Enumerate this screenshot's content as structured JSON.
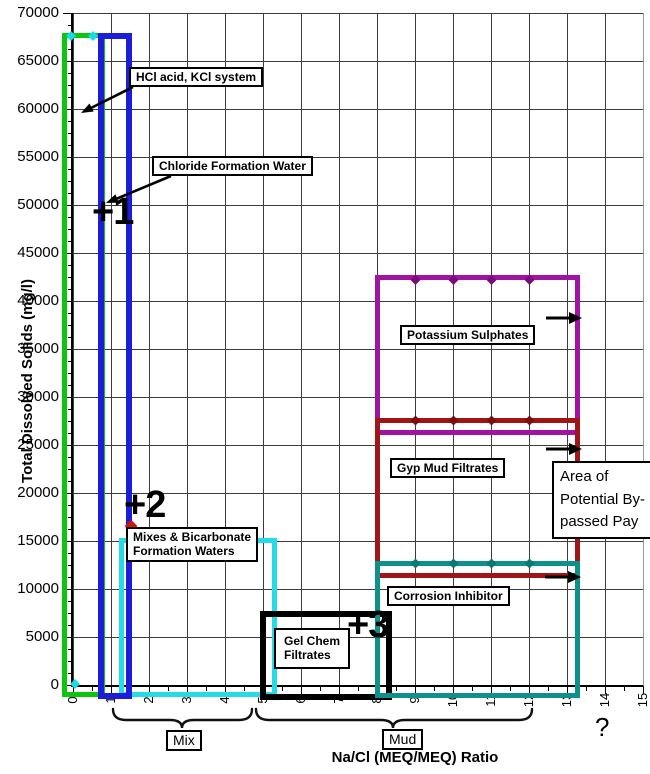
{
  "y_axis": {
    "title": "Total Dissolved Solids (mg/l)",
    "ticks": [
      "70000",
      "65000",
      "60000",
      "55000",
      "50000",
      "45000",
      "40000",
      "35000",
      "30000",
      "25000",
      "20000",
      "15000",
      "10000",
      "5000",
      "0"
    ]
  },
  "x_axis": {
    "title": "Na/Cl (MEQ/MEQ) Ratio",
    "ticks": [
      "0",
      "1",
      "2",
      "3",
      "4",
      "5",
      "6",
      "7",
      "8",
      "9",
      "10",
      "11",
      "12",
      "13",
      "14",
      "15"
    ]
  },
  "labels": {
    "hcl": "HCl acid, KCl system",
    "chloride": "Chloride Formation Water",
    "mixes_line1": "Mixes & Bicarbonate",
    "mixes_line2": "Formation Waters",
    "potassium": "Potassium Sulphates",
    "gyp": "Gyp Mud Filtrates",
    "corrosion": "Corrosion Inhibitor",
    "gel_line1": "Gel Chem",
    "gel_line2": "Filtrates",
    "area_line1": "Area of",
    "area_line2": "Potential By-",
    "area_line3": "passed Pay",
    "plus1": "+1",
    "plus2": "+2",
    "plus3": "+3",
    "mix": "Mix",
    "mud": "Mud",
    "question": "?"
  },
  "chart_data": {
    "type": "area",
    "title": "",
    "xlabel": "Na/Cl (MEQ/MEQ) Ratio",
    "ylabel": "Total Dissolved Solids (mg/l)",
    "xlim": [
      0,
      15
    ],
    "ylim": [
      0,
      70000
    ],
    "x_tick_step": 1,
    "y_tick_step": 5000,
    "y_minor_step": 1250,
    "grid": true,
    "regions": [
      {
        "label": "HCl acid, KCl system",
        "color": "#0bc60b",
        "x_range": [
          -0.25,
          0.5
        ],
        "y_range": [
          0,
          67500
        ]
      },
      {
        "label": "Chloride Formation Water",
        "color": "#1c1cd9",
        "x_range": [
          0.7,
          1.15
        ],
        "y_range": [
          0,
          67500
        ]
      },
      {
        "label": "Mixes & Bicarbonate Formation Waters",
        "color": "#25dbe7",
        "x_range": [
          1.2,
          5
        ],
        "y_range": [
          0,
          15000
        ]
      },
      {
        "label": "Gel Chem Filtrates",
        "color": "#000000",
        "x_range": [
          5,
          8
        ],
        "y_range": [
          0,
          7500
        ]
      },
      {
        "label": "Potassium Sulphates",
        "color": "#a113a1",
        "x_range": [
          8,
          13
        ],
        "y_range": [
          27500,
          42500
        ]
      },
      {
        "label": "Gyp Mud Filtrates",
        "color": "#a01616",
        "x_range": [
          8,
          13
        ],
        "y_range": [
          12500,
          27500
        ]
      },
      {
        "label": "Corrosion Inhibitor",
        "color": "#0d9189",
        "x_range": [
          8,
          13
        ],
        "y_range": [
          0,
          12500
        ]
      }
    ],
    "annotations": [
      {
        "text": "+1",
        "x": 1.0,
        "y": 48500
      },
      {
        "text": "+2",
        "x": 1.7,
        "y": 18500
      },
      {
        "text": "+3",
        "x": 7.9,
        "y": 6000
      },
      {
        "text": "Area of Potential By-passed Pay",
        "x": 13.6,
        "y": 17500
      },
      {
        "text": "?",
        "x": 14.0,
        "y": -4500
      },
      {
        "text": "Mix",
        "bracket_x_range": [
          1.0,
          4.7
        ]
      },
      {
        "text": "Mud",
        "bracket_x_range": [
          4.8,
          12.1
        ]
      }
    ],
    "point_markers": [
      {
        "color": "#d01414",
        "x": 1.5,
        "y": 16500
      }
    ],
    "arrows_right_at_y": [
      38200,
      24600,
      11300
    ]
  }
}
